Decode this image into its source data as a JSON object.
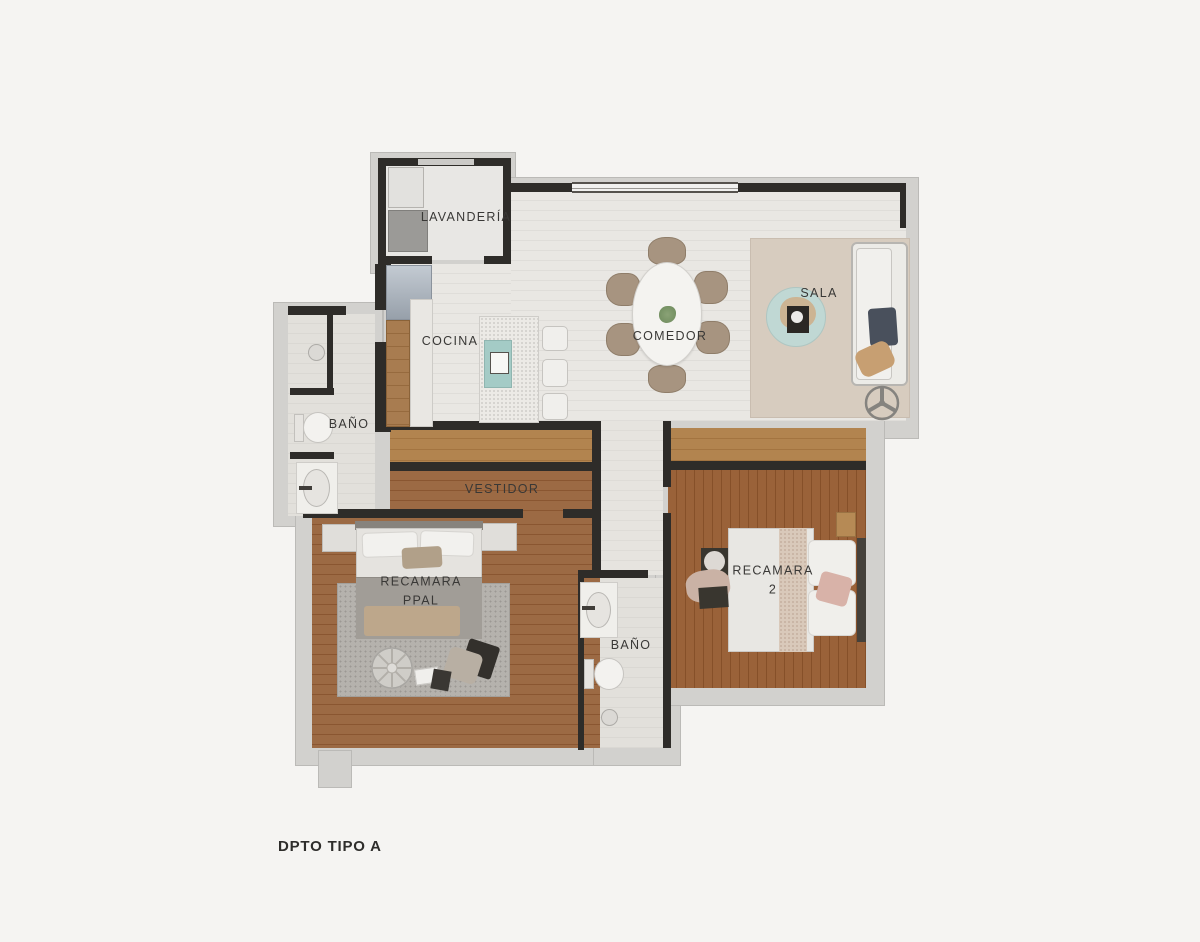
{
  "title": "DPTO TIPO A",
  "rooms": {
    "lavanderia": "LAVANDERÍA",
    "cocina": "COCINA",
    "comedor": "COMEDOR",
    "sala": "SALA",
    "bano_1": "BAÑO",
    "vestidor": "VESTIDOR",
    "recamara_ppal": {
      "line1": "RECAMARA",
      "line2": "PPAL"
    },
    "bano_2": "BAÑO",
    "recamara_2": {
      "line1": "RECAMARA",
      "line2": "2"
    }
  },
  "colors": {
    "background": "#f5f4f2",
    "exterior_wall": "#d2d1ce",
    "interior_wall": "#2e2c29",
    "tile_floor": "#e9e7e3",
    "wood_floor_master": "#9c6a44",
    "wood_floor_bedroom2": "#9a6239",
    "closet_wood": "#b2844f",
    "sala_rug": "#d7ccbf",
    "bedroom_rug": "#b5b2ad",
    "sink_teal": "#a4cbc6",
    "coffee_table_teal": "#c0d8d4",
    "sofa_cushion_navy": "#49505c",
    "label_text": "#393836"
  }
}
